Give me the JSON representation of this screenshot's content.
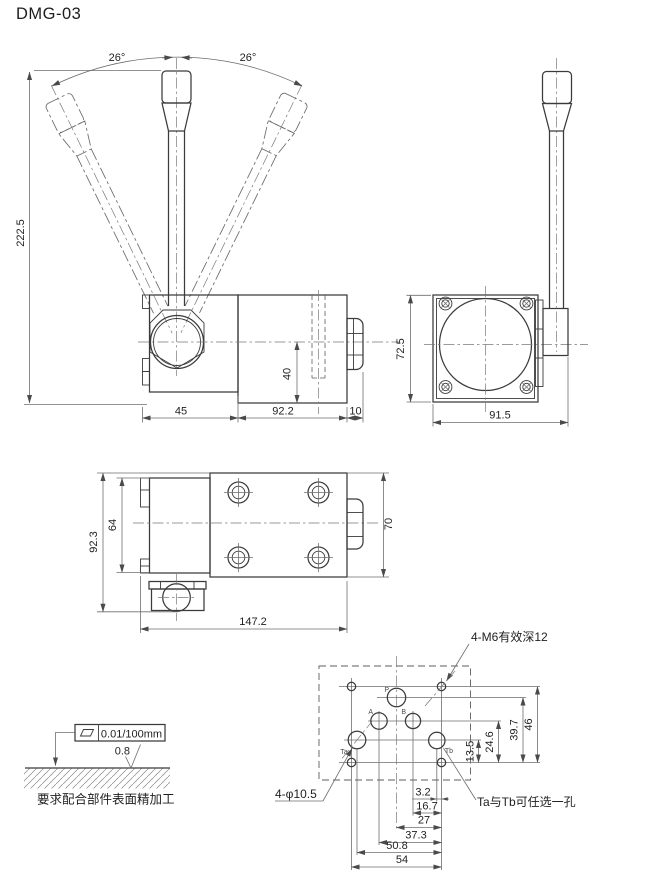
{
  "title": "DMG-03",
  "colors": {
    "line": "#3b3b3b",
    "dim": "#6e6e6e",
    "text": "#222222",
    "background": "#ffffff"
  },
  "front_view": {
    "angle_left": "26°",
    "angle_right": "26°",
    "dim_total_height": "222.5",
    "dim_lever_housing_width": "45",
    "dim_body_length": "92.2",
    "dim_end_cap": "10",
    "dim_port_height": "40"
  },
  "side_view": {
    "dim_body_height": "72.5",
    "dim_total_width": "91.5"
  },
  "top_view": {
    "dim_total_height": "92.3",
    "dim_inner_height": "64",
    "dim_body_width": "70",
    "dim_total_length": "147.2"
  },
  "mounting_pattern": {
    "note_m6": "4-M6有效深12",
    "note_phi": "4-φ10.5",
    "note_ta_tb": "Ta与Tb可任选一孔",
    "port_labels": {
      "p": "P",
      "a": "A",
      "b": "B",
      "ta": "Ta",
      "tb": "Tb"
    },
    "dims_vertical": [
      "13.5",
      "24.6",
      "39.7",
      "46"
    ],
    "dims_horizontal": [
      "3.2",
      "16.7",
      "27",
      "37.3",
      "50.8",
      "54"
    ]
  },
  "surface_note": {
    "flatness_tolerance": "0.01/100mm",
    "roughness": "0.8",
    "caption": "要求配合部件表面精加工"
  }
}
